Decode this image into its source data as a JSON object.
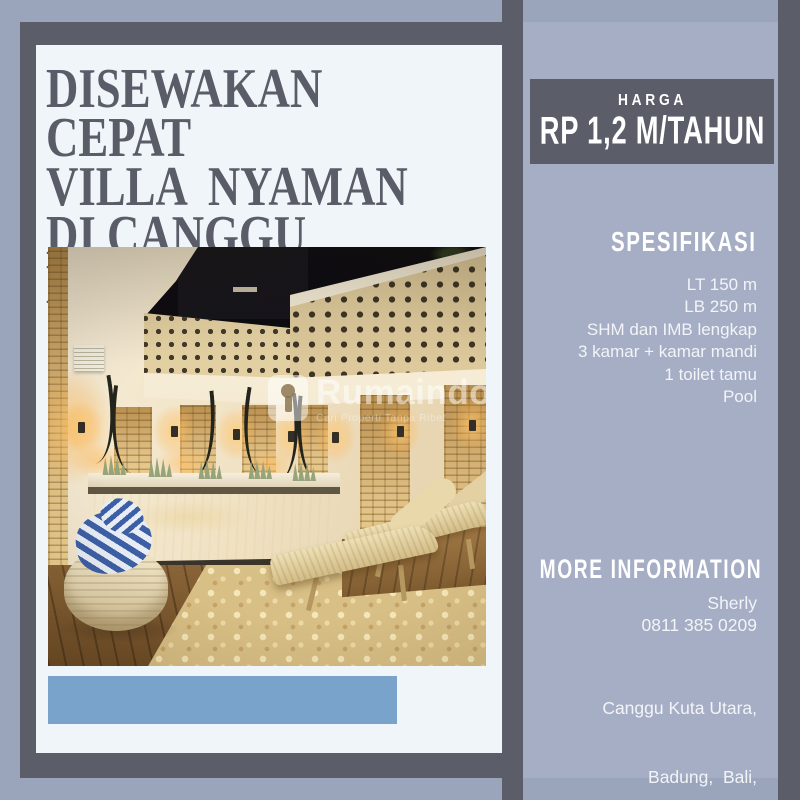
{
  "poster": {
    "title": [
      "DISEWAKAN CEPAT",
      "VILLA  NYAMAN",
      "DI CANGGU BALI"
    ],
    "price": {
      "label": "HARGA",
      "value": "RP 1,2 M/TAHUN"
    },
    "spec": {
      "heading": "SPESIFIKASI",
      "items": [
        "LT 150 m",
        "LB 250 m",
        "SHM dan IMB lengkap",
        "3 kamar + kamar mandi",
        "1 toilet tamu",
        "Pool"
      ]
    },
    "contact": {
      "heading": "MORE INFORMATION",
      "name": "Sherly",
      "phone": "0811 385 0209",
      "address": [
        "Canggu Kuta Utara,",
        "Badung,  Bali,"
      ]
    },
    "watermark": {
      "brand": "Rumaindo",
      "tagline": "Cari Properti Tanpa Ribet"
    },
    "colors": {
      "background": "#9aa4bb",
      "sidebar_panel": "#a5aec4",
      "dark_frame": "#5b5d69",
      "card": "#eff5f8",
      "accent_bar": "#7aa3cc",
      "title_text": "#5a5c68",
      "sidebar_text": "#f2f4f8"
    }
  }
}
